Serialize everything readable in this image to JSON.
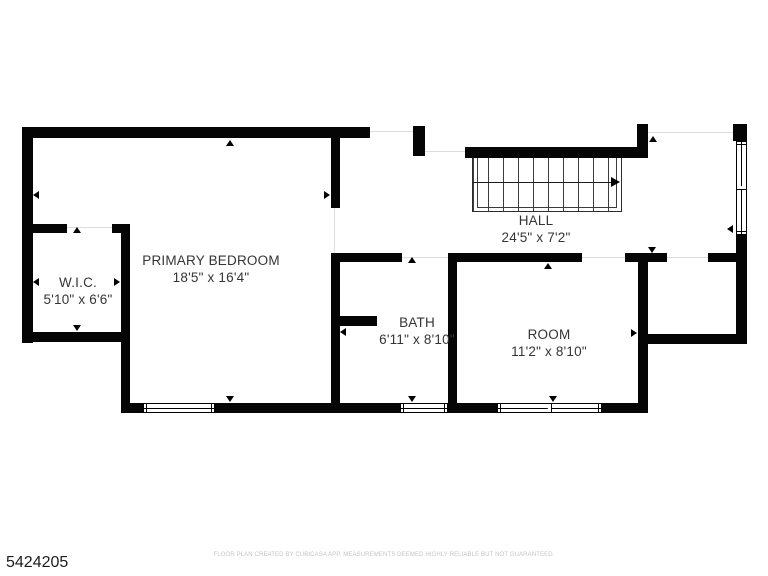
{
  "plan": {
    "rooms": [
      {
        "name": "PRIMARY BEDROOM",
        "dims": "18'5\" x 16'4\""
      },
      {
        "name": "W.I.C.",
        "dims": "5'10\" x 6'6\""
      },
      {
        "name": "BATH",
        "dims": "6'11\" x 8'10\""
      },
      {
        "name": "ROOM",
        "dims": "11'2\" x 8'10\""
      },
      {
        "name": "HALL",
        "dims": "24'5\" x 7'2\""
      }
    ],
    "stairs": {
      "direction": "right"
    }
  },
  "footer": {
    "listing_id": "5424205",
    "disclaimer": "FLOOR PLAN CREATED BY CUBICASA APP. MEASUREMENTS DEEMED HIGHLY RELIABLE BUT NOT GUARANTEED."
  },
  "colors": {
    "wall": "#050505",
    "label": "#353535",
    "disclaimer": "#c4c4c4"
  }
}
